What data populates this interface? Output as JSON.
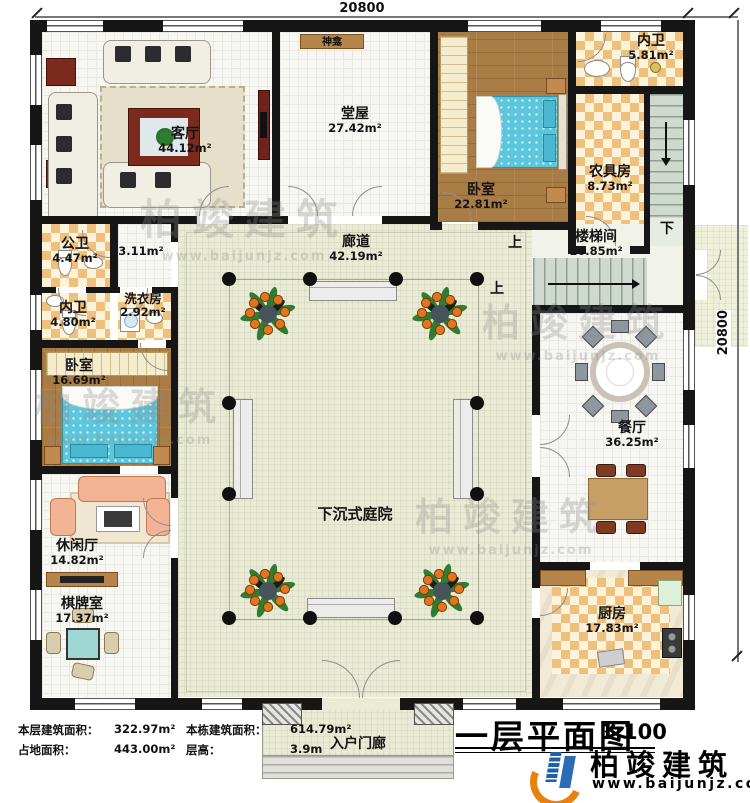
{
  "dimensions": {
    "top": "20800",
    "right": "20800"
  },
  "rooms": {
    "keting": {
      "name": "客厅",
      "area": "44.12m²"
    },
    "shenkan": {
      "name": "神龛"
    },
    "tangwu": {
      "name": "堂屋",
      "area": "27.42m²"
    },
    "woshi_top": {
      "name": "卧室",
      "area": "22.81m²"
    },
    "neiwei_top": {
      "name": "内卫",
      "area": "5.81m²"
    },
    "nongjufang": {
      "name": "农具房",
      "area": "8.73m²"
    },
    "loutijian": {
      "name": "楼梯间",
      "area": "16.85m²"
    },
    "langdao": {
      "name": "廊道",
      "area": "42.19m²"
    },
    "gongwei": {
      "name": "公卫",
      "area": "4.47m²"
    },
    "hall": {
      "area": "3.11m²"
    },
    "neiwei_left": {
      "name": "内卫",
      "area": "4.80m²"
    },
    "xiyifang": {
      "name": "洗衣房",
      "area": "2.92m²"
    },
    "woshi_left": {
      "name": "卧室",
      "area": "16.69m²"
    },
    "xiuxianting": {
      "name": "休闲厅",
      "area": "14.82m²"
    },
    "qipaishi": {
      "name": "棋牌室",
      "area": "17.37m²"
    },
    "tingyuan": {
      "name": "下沉式庭院"
    },
    "canting": {
      "name": "餐厅",
      "area": "36.25m²"
    },
    "chufang": {
      "name": "厨房",
      "area": "17.83m²"
    },
    "rumenlang": {
      "name": "入户门廊"
    }
  },
  "stairs": {
    "up": "上",
    "down": "下"
  },
  "stats": {
    "floor_area_label": "本层建筑面积：",
    "floor_area": "322.97m²",
    "total_area_label": "本栋建筑面积：",
    "total_area": "614.79m²",
    "footprint_label": "占地面积：",
    "footprint": "443.00m²",
    "height_label": "层高：",
    "height": "3.9m"
  },
  "titleblock": {
    "title": "一层平面图",
    "scale": "1:100"
  },
  "brand": {
    "name": "柏竣建筑",
    "url": "www.baijunjz.com"
  },
  "watermark": {
    "name": "柏竣建筑",
    "url": "www.baijunjz.com"
  }
}
